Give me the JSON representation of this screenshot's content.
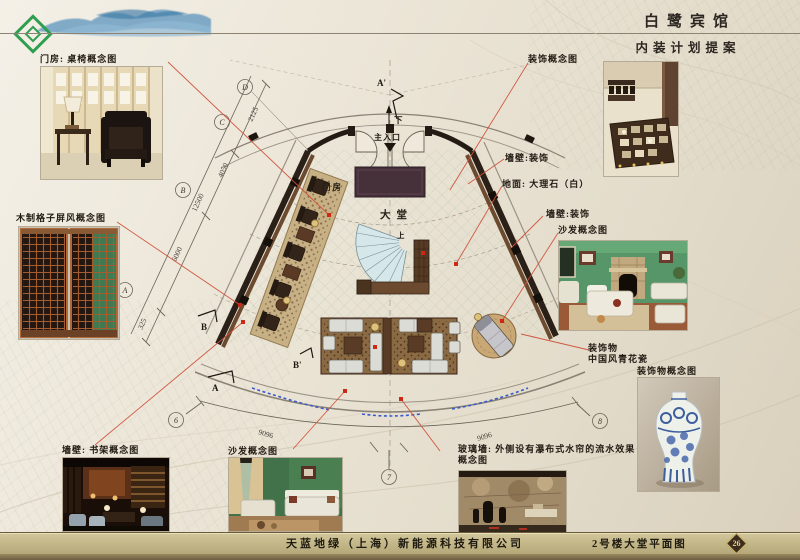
{
  "header": {
    "title": "白鹭宾馆",
    "subtitle": "内装计划提案"
  },
  "footer": {
    "company": "天蓝地绿（上海）新能源科技有限公司",
    "drawing_title": "2号楼大堂平面图",
    "page": "26"
  },
  "callouts": {
    "menfang_photo": "门房: 桌椅概念图",
    "lattice": "木制格子屏风概念图",
    "bookshelf": "墙壁: 书架概念图",
    "sofa_bottom": "沙发概念图",
    "glass_line1": "玻璃墙: 外侧设有瀑布式水帘的流水效果",
    "glass_line2": "概念图",
    "decor_top": "装饰概念图",
    "wall_decor_1": "墙壁:装饰",
    "floor_marble": "地面: 大理石（白）",
    "wall_decor_2": "墙壁:装饰",
    "sofa_right": "沙发概念图",
    "ornament_line1": "装饰物",
    "ornament_line2": "中国风青花瓷",
    "vase": "装饰物概念图"
  },
  "plan": {
    "room_menfang": "门房",
    "room_lobby": "大堂",
    "main_entrance": "主入口",
    "dir_down": "下",
    "dir_up": "上",
    "section_a_prime": "A'",
    "section_a": "A",
    "section_b": "B",
    "section_b_prime": "B'",
    "grid_a": "A",
    "grid_b": "B",
    "grid_c": "C",
    "grid_d": "D",
    "grid_6": "6",
    "grid_7": "7",
    "grid_8": "8",
    "dim_325": "325",
    "dim_6000": "6000",
    "dim_12500": "12500",
    "dim_4050": "4050",
    "dim_2125": "2125",
    "dim_arc_left": "9096",
    "dim_arc_right": "9096"
  },
  "colors": {
    "leader_red": "#d0503a",
    "accent_green": "#2f9e4f",
    "band_gold": "#c2b588"
  }
}
